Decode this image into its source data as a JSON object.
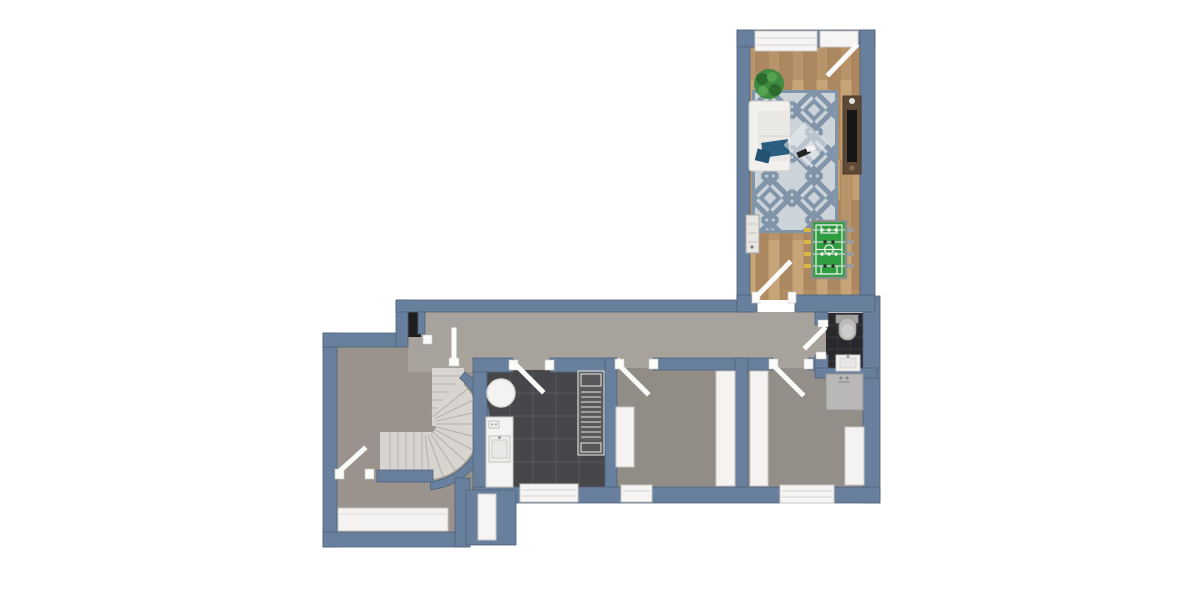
{
  "colors": {
    "wall": "#68809d",
    "wall_edge": "#516379",
    "corridor_floor": "#a8a29c",
    "left_room_floor": "#9a938d",
    "bedroom_floor": "#928c87",
    "bathroom_floor": "#948e89",
    "wood_light": "#c29e72",
    "wood_mid": "#b8946a",
    "wood_dark": "#a7805a",
    "kitchen_floor": "#47474b",
    "kitchen_grout": "#58585c",
    "wc_floor": "#29292d",
    "wc_grout": "#3b3b3f",
    "stair_tread": "#d8d5d1",
    "stair_edge": "#b3afab",
    "white_fixture": "#f4f3f1",
    "window": "#f6f5f3",
    "door_leaf": "#fbfbfa",
    "rug_base": "#cdd4d9",
    "rug_pattern": "#8095a9",
    "sofa": "#f1f0ed",
    "blanket": "#2a5d80",
    "console": "#5e4936",
    "tv": "#161616",
    "plant": "#3f8c41",
    "plant_dark": "#2c6a2f",
    "foosball_green": "#2f9e41",
    "foosball_frame": "#8a8d8a",
    "handle_yellow": "#d9bb3f",
    "handle_gray": "#9b9b9b",
    "shower": "#b9b8b6",
    "toilet": "#bdbbb9",
    "niche": "#1e1e20"
  },
  "plan": {
    "rooms": [
      "living-room",
      "hallway",
      "kitchen",
      "bedroom",
      "bedroom-2",
      "wc",
      "stair-room"
    ],
    "fixtures": [
      "sofa",
      "area-rug",
      "coffee-table",
      "tv-console",
      "tv",
      "potted-plant",
      "radiator",
      "foosball-table",
      "toilet",
      "wc-sink",
      "shower",
      "wardrobe",
      "kitchen-table",
      "kitchen-counter-sink",
      "kitchen-appliance",
      "sideboard",
      "spiral-staircase",
      "window",
      "door",
      "entry-door",
      "niche"
    ]
  }
}
